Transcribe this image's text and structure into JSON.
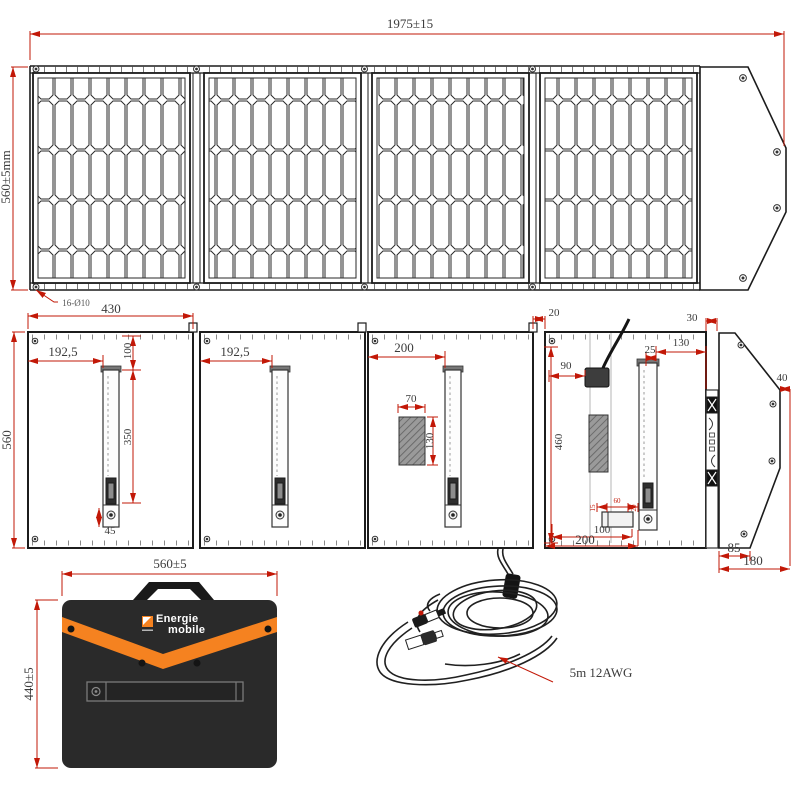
{
  "dims": {
    "top_width": "1975±15",
    "top_height": "560±5mm",
    "hole_note": "16-Ø10",
    "bk_panel_w": "430",
    "bk_h": "560",
    "p1_offset": "192,5",
    "p1_top": "100",
    "p1_len": "350",
    "p1_foot": "45",
    "p2_offset": "192,5",
    "p3_offset": "200",
    "p3_pocket_w": "70",
    "p3_pocket_h": "130",
    "p4_gap": "20",
    "p4_strip": "30",
    "p4_box": "90",
    "p4_inner_h": "460",
    "p4_leg_gap": "25",
    "p4_leg_strip": "130",
    "p4_h15": "15",
    "p4_h60": "60",
    "p4_h20": "20",
    "p4_b100": "100",
    "p4_b200": "200",
    "flap_40": "40",
    "flap_85": "85",
    "flap_180": "180",
    "bag_w": "560±5",
    "bag_h": "440±5"
  },
  "cable": {
    "label": "5m  12AWG"
  },
  "logo": {
    "line1": "Energie",
    "line2": "mobile"
  },
  "colors": {
    "dimension_red": "#c21807",
    "line_black": "#1c1c1c",
    "brand_orange": "#f58220",
    "bag_dark": "#2a2a2a"
  }
}
